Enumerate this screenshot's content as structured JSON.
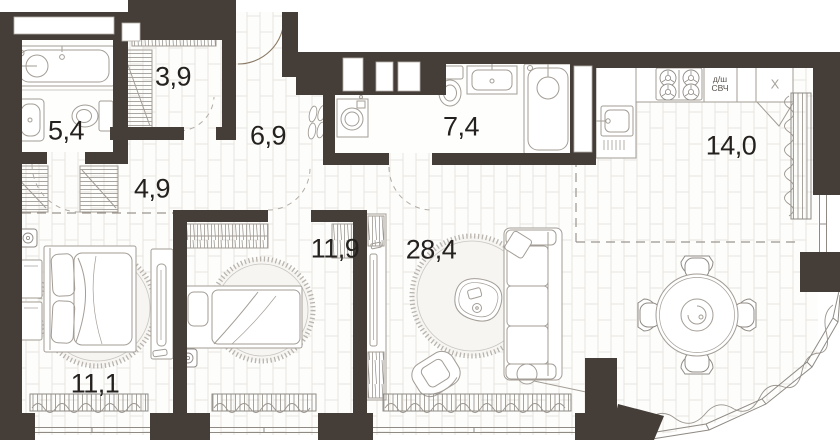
{
  "plan": {
    "type": "apartment-floor-plan",
    "wall_color": "#453e38",
    "furniture_line_color": "#a39d96",
    "tile_line_color": "#e8e5e0",
    "rooms": [
      {
        "id": "bathroom-small",
        "area": "5,4"
      },
      {
        "id": "wardrobe-room",
        "area": "3,9"
      },
      {
        "id": "hallway",
        "area": "4,9"
      },
      {
        "id": "corridor",
        "area": "6,9"
      },
      {
        "id": "bathroom-large",
        "area": "7,4"
      },
      {
        "id": "kitchen-zone",
        "area": "14,0"
      },
      {
        "id": "bedroom-small",
        "area": "11,9"
      },
      {
        "id": "living-room",
        "area": "28,4"
      },
      {
        "id": "bedroom-master",
        "area": "11,1"
      }
    ],
    "appliances": {
      "dishwasher_microwave": "д/ш\nСВЧ",
      "fridge": "X"
    }
  }
}
